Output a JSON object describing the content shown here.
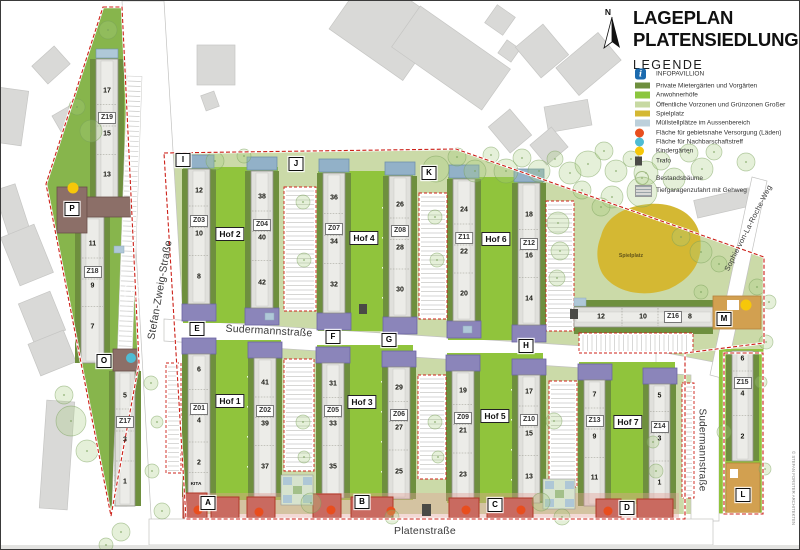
{
  "title": {
    "line1": "LAGEPLAN",
    "line2": "PLATENSIEDLUNG"
  },
  "legend": {
    "heading": "LEGENDE",
    "items": [
      {
        "label": "INFOPAVILLION",
        "swatch": "info"
      },
      {
        "label": "Private Mietergärten und Vorgärten",
        "swatch": "rect",
        "color": "#6E8F3E"
      },
      {
        "label": "Anwohnerhöfe",
        "swatch": "rect",
        "color": "#8CC63E"
      },
      {
        "label": "Öffentliche Vorzonen und Grünzonen Großer",
        "swatch": "rect",
        "color": "#C7D9A2"
      },
      {
        "label": "Spielplatz",
        "swatch": "rect",
        "color": "#D4B833"
      },
      {
        "label": "Müllstellplätze im Aussenbereich",
        "swatch": "rect",
        "color": "#BCD0DB"
      },
      {
        "label": "Fläche für gebietsnahe Versorgung (Läden)",
        "swatch": "circle",
        "color": "#E84E1E"
      },
      {
        "label": "Fläche für Nachbarschaftstreff",
        "swatch": "circle",
        "color": "#4FBCD4"
      },
      {
        "label": "Kindergärten",
        "swatch": "circle",
        "color": "#F6C70A"
      },
      {
        "label": "Trafo",
        "swatch": "square",
        "color": "#4A4A46"
      },
      {
        "label": "Bestandsbäume",
        "swatch": "tree"
      },
      {
        "label": "Tiefgaragenzufahrt mit Gehweg",
        "swatch": "garage"
      }
    ]
  },
  "north": {
    "label": "N"
  },
  "icons": {
    "info_glyph": "i"
  },
  "credit": "© STEFAN FORSTER ARCHITEKTEN",
  "streets": {
    "stefan_zweig": "Stefan-Zweig-Straße",
    "sudermann_h": "Sudermannstraße",
    "sudermann_v": "Sudermannstraße",
    "platen": "Platenstraße",
    "sophie": "Sophie-von-La-Roche-Weg"
  },
  "areas": {
    "spielplatz": "Spielplatz",
    "kita": "KITA"
  },
  "hofs": [
    {
      "label": "Hof 1"
    },
    {
      "label": "Hof 2"
    },
    {
      "label": "Hof 3"
    },
    {
      "label": "Hof 4"
    },
    {
      "label": "Hof 5"
    },
    {
      "label": "Hof 6"
    },
    {
      "label": "Hof 7"
    }
  ],
  "markers": [
    {
      "label": "A"
    },
    {
      "label": "B"
    },
    {
      "label": "C"
    },
    {
      "label": "D"
    },
    {
      "label": "E"
    },
    {
      "label": "F"
    },
    {
      "label": "G"
    },
    {
      "label": "H"
    },
    {
      "label": "I"
    },
    {
      "label": "J"
    },
    {
      "label": "K"
    },
    {
      "label": "L"
    },
    {
      "label": "M"
    },
    {
      "label": "O"
    },
    {
      "label": "P"
    }
  ],
  "buildings": [
    {
      "id": "Z01",
      "numbers": [
        "6",
        "4",
        "2"
      ],
      "kita": true
    },
    {
      "id": "Z02",
      "numbers": [
        "41",
        "39",
        "37"
      ]
    },
    {
      "id": "Z03",
      "numbers": [
        "12",
        "10",
        "8"
      ]
    },
    {
      "id": "Z04",
      "numbers": [
        "38",
        "40",
        "42"
      ]
    },
    {
      "id": "Z05",
      "numbers": [
        "31",
        "33",
        "35"
      ]
    },
    {
      "id": "Z06",
      "numbers": [
        "29",
        "27",
        "25"
      ]
    },
    {
      "id": "Z07",
      "numbers": [
        "36",
        "34",
        "32"
      ]
    },
    {
      "id": "Z08",
      "numbers": [
        "26",
        "28",
        "30"
      ]
    },
    {
      "id": "Z09",
      "numbers": [
        "19",
        "21",
        "23"
      ]
    },
    {
      "id": "Z10",
      "numbers": [
        "17",
        "15",
        "13"
      ]
    },
    {
      "id": "Z11",
      "numbers": [
        "24",
        "22",
        "20"
      ]
    },
    {
      "id": "Z12",
      "numbers": [
        "18",
        "16",
        "14"
      ]
    },
    {
      "id": "Z13",
      "numbers": [
        "7",
        "9",
        "11"
      ]
    },
    {
      "id": "Z14",
      "numbers": [
        "5",
        "3",
        "1"
      ]
    },
    {
      "id": "Z15",
      "numbers": [
        "6",
        "4",
        "2"
      ]
    },
    {
      "id": "Z16",
      "numbers": [
        "12",
        "10",
        "8"
      ]
    },
    {
      "id": "Z17",
      "numbers": [
        "5",
        "3",
        "1"
      ]
    },
    {
      "id": "Z18",
      "numbers": [
        "11",
        "9",
        "7"
      ]
    },
    {
      "id": "Z19",
      "numbers": [
        "17",
        "15",
        "13"
      ]
    }
  ],
  "colors": {
    "boundary": "#CC2018",
    "court_green": "#90C43C",
    "site_green": "#CBDAA8",
    "triangle_green": "#87B54C",
    "olive": "#6E8F3E",
    "slab": "#E0E0DC",
    "purple": "#8B85BA",
    "bluehead": "#92B1C8",
    "red_building": "#C96A60",
    "red_border": "#B03828",
    "tan": "#D2A050",
    "brown": "#8C6F68",
    "spielplatz": "#D4B833",
    "muell": "#AFC8D8",
    "laeden": "#E84E1E",
    "nachbarschaft": "#4FBCD4",
    "kindergarten": "#F6C70A",
    "trafo": "#4A4A46",
    "info": "#1B6AAE",
    "context": "#D9D9D7"
  }
}
